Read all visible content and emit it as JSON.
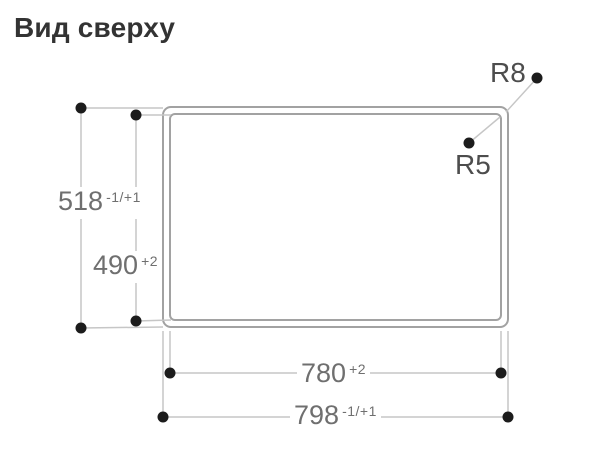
{
  "title": "Вид сверху",
  "labels": {
    "dim_height_outer": {
      "value": "518",
      "tol": "-1/+1"
    },
    "dim_height_inner": {
      "value": "490",
      "tol": "+2"
    },
    "dim_width_inner": {
      "value": "780",
      "tol": "+2"
    },
    "dim_width_outer": {
      "value": "798",
      "tol": "-1/+1"
    },
    "radius_outer": "R8",
    "radius_inner": "R5"
  },
  "colors": {
    "dimension_line": "#c6c6c6",
    "cutout_border": "#a2a2a2",
    "marker_dot": "#1c1c1c",
    "dimension_text": "#6f6f6f",
    "radius_text": "#4d4d4d",
    "title_text": "#333333"
  }
}
